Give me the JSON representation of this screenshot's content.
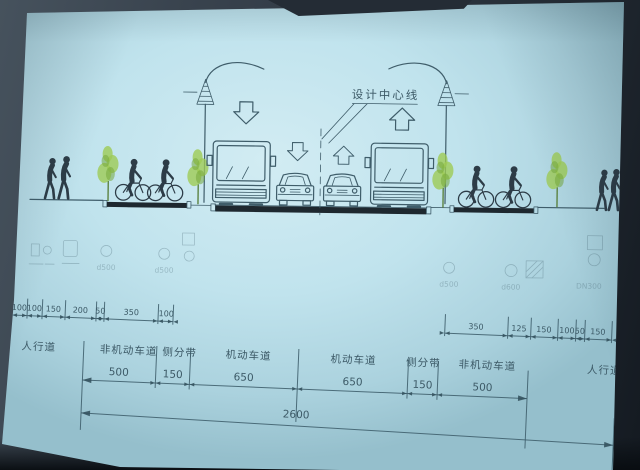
{
  "drawing": {
    "center_line_label": "设计中心线",
    "lane_labels": {
      "sidewalk_left": "人行道",
      "nonmotor_left": "非机动车道",
      "median_left": "侧分带",
      "motor_left": "机动车道",
      "motor_right": "机动车道",
      "median_right": "侧分带",
      "nonmotor_right": "非机动车道",
      "sidewalk_right": "人行道"
    },
    "dims": {
      "upper_left": [
        "100",
        "100",
        "150",
        "200",
        "50",
        "350",
        "100"
      ],
      "upper_right": [
        "350",
        "125",
        "150",
        "100",
        "50",
        "150"
      ],
      "lanes": [
        "500",
        "150",
        "650",
        "650",
        "150",
        "500"
      ],
      "total": "2600"
    },
    "utilities": [
      "d500",
      "d500",
      "d500",
      "d600",
      "DN300"
    ],
    "colors": {
      "slide": "#c0e3ed",
      "ink": "#3f5d6a",
      "road": "#1e282f",
      "tree": "#9ecb55"
    }
  }
}
